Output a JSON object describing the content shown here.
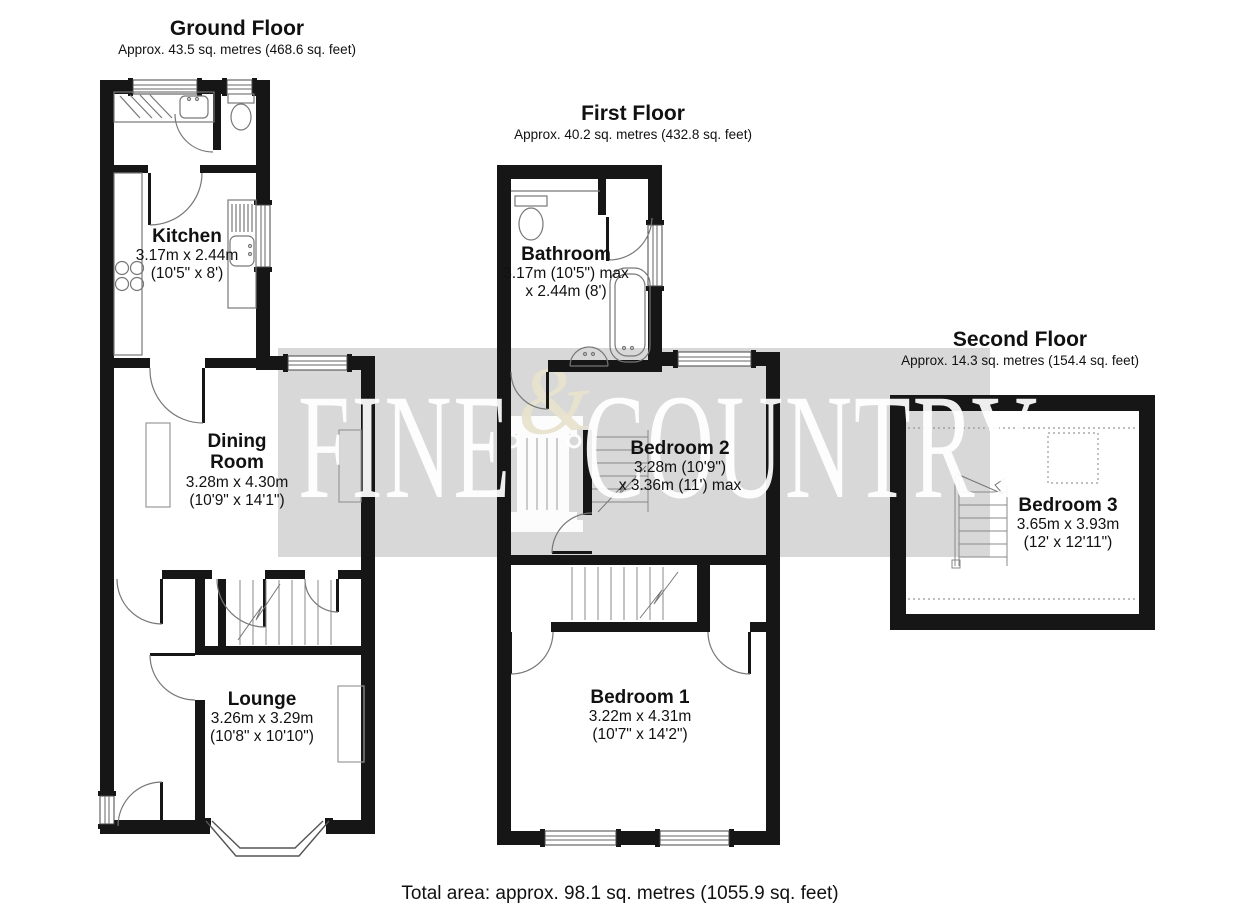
{
  "page": {
    "total_area": "Total area: approx. 98.1 sq. metres (1055.9 sq. feet)"
  },
  "watermark": {
    "left_word": "FINE",
    "right_word": "COUNTRY",
    "ampersand": "&",
    "band_color": "#d8d8d8",
    "letter_color": "#ffffff",
    "ampersand_color": "#e8e3cd"
  },
  "floors": {
    "ground": {
      "title": "Ground Floor",
      "subtitle": "Approx. 43.5 sq. metres (468.6 sq. feet)",
      "rooms": {
        "kitchen": {
          "name": "Kitchen",
          "dims1": "3.17m x 2.44m",
          "dims2": "(10'5\" x 8')"
        },
        "dining": {
          "name": "Dining Room",
          "dims1": "3.28m x 4.30m",
          "dims2": "(10'9\" x 14'1\")"
        },
        "lounge": {
          "name": "Lounge",
          "dims1": "3.26m x 3.29m",
          "dims2": "(10'8\" x 10'10\")"
        }
      }
    },
    "first": {
      "title": "First Floor",
      "subtitle": "Approx. 40.2 sq. metres (432.8 sq. feet)",
      "rooms": {
        "bathroom": {
          "name": "Bathroom",
          "dims1": "3.17m (10'5\") max",
          "dims2": "x 2.44m (8')"
        },
        "bedroom2": {
          "name": "Bedroom 2",
          "dims1": "3.28m (10'9\")",
          "dims2": "x 3.36m (11') max"
        },
        "bedroom1": {
          "name": "Bedroom 1",
          "dims1": "3.22m x 4.31m",
          "dims2": "(10'7\" x 14'2\")"
        }
      }
    },
    "second": {
      "title": "Second Floor",
      "subtitle": "Approx. 14.3 sq. metres (154.4 sq. feet)",
      "rooms": {
        "bedroom3": {
          "name": "Bedroom 3",
          "dims1": "3.65m x 3.93m",
          "dims2": "(12' x 12'11\")"
        }
      }
    }
  }
}
